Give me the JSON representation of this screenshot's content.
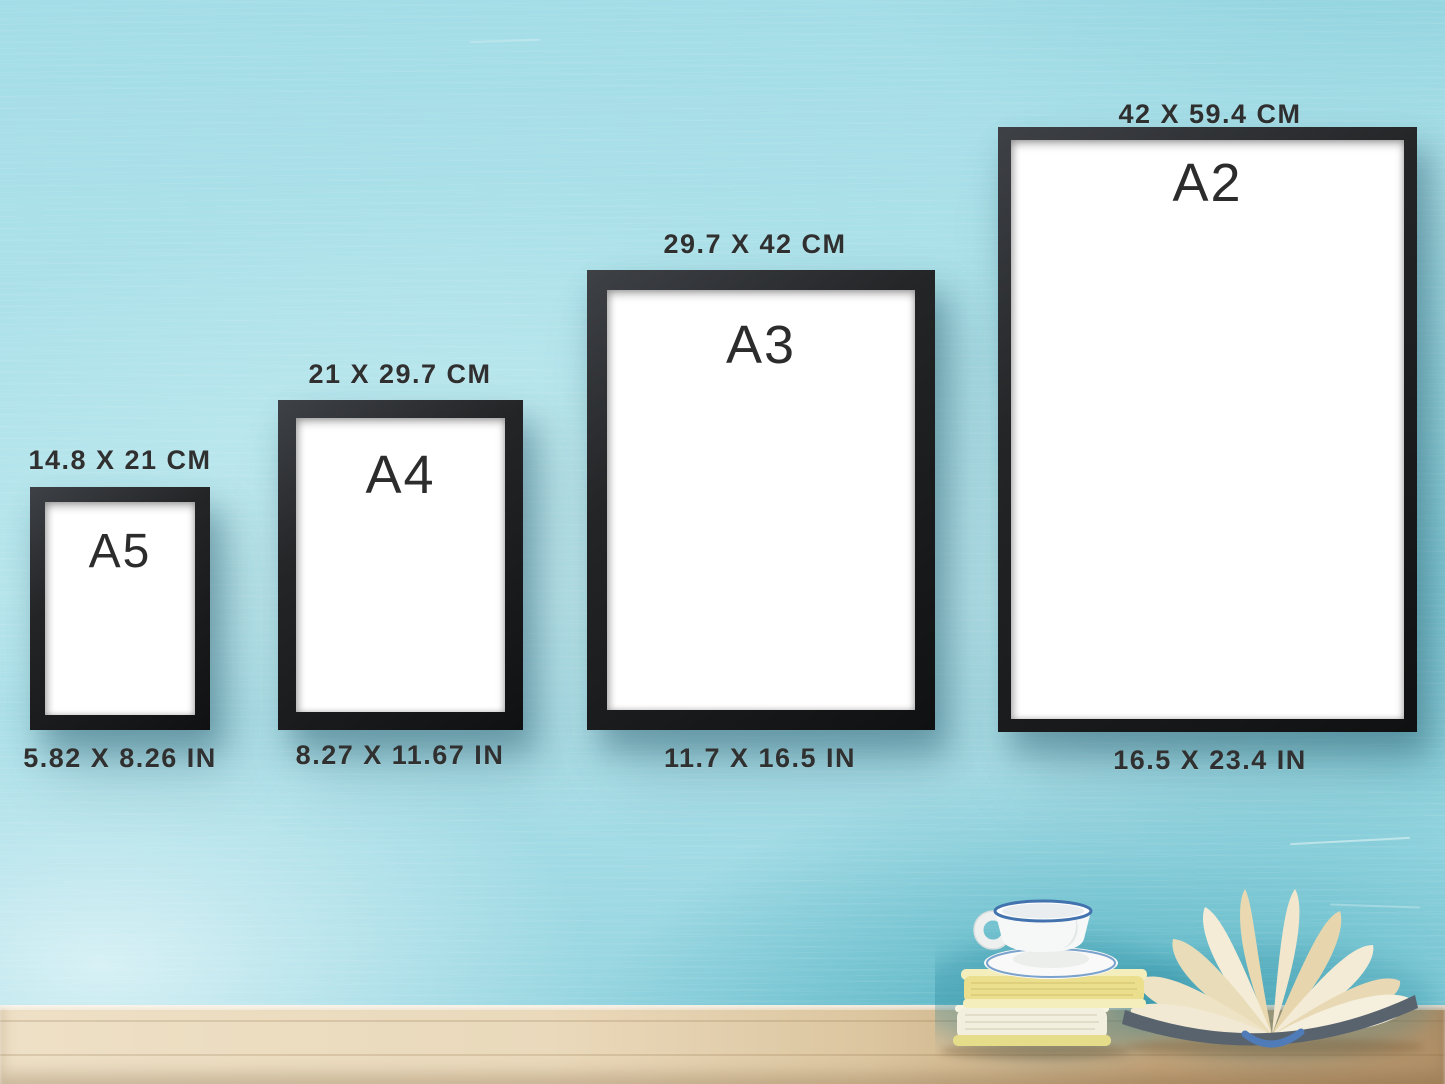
{
  "frames": [
    {
      "id": "a5",
      "label": "A5",
      "size_cm": "14.8 X 21 CM",
      "size_in": "5.82 X 8.26 IN"
    },
    {
      "id": "a4",
      "label": "A4",
      "size_cm": "21 X 29.7 CM",
      "size_in": "8.27 X 11.67 IN"
    },
    {
      "id": "a3",
      "label": "A3",
      "size_cm": "29.7 X 42 CM",
      "size_in": "11.7 X 16.5 IN"
    },
    {
      "id": "a2",
      "label": "A2",
      "size_cm": "42 X 59.4 CM",
      "size_in": "16.5 X 23.4 IN"
    }
  ],
  "colors": {
    "wall_light": "#aee2ea",
    "wall_deep_teal": "#3fb0c2",
    "frame_black": "#1c1e20",
    "poster_white": "#ffffff",
    "text_dark": "#303030",
    "table_wood_light": "#ead9bb",
    "table_wood_dark": "#b09068",
    "cup_rim_blue": "#4273ae",
    "book_pages_yellow": "#ece08c",
    "open_book_pages_cream": "#f1e9d4"
  },
  "scene_objects": {
    "cup": "white-coffee-cup-on-saucer",
    "books": "stack-of-two-yellow-books",
    "open_book": "open-fanned-book",
    "table": "wooden-table",
    "wall": "turquoise-painted-wall"
  }
}
